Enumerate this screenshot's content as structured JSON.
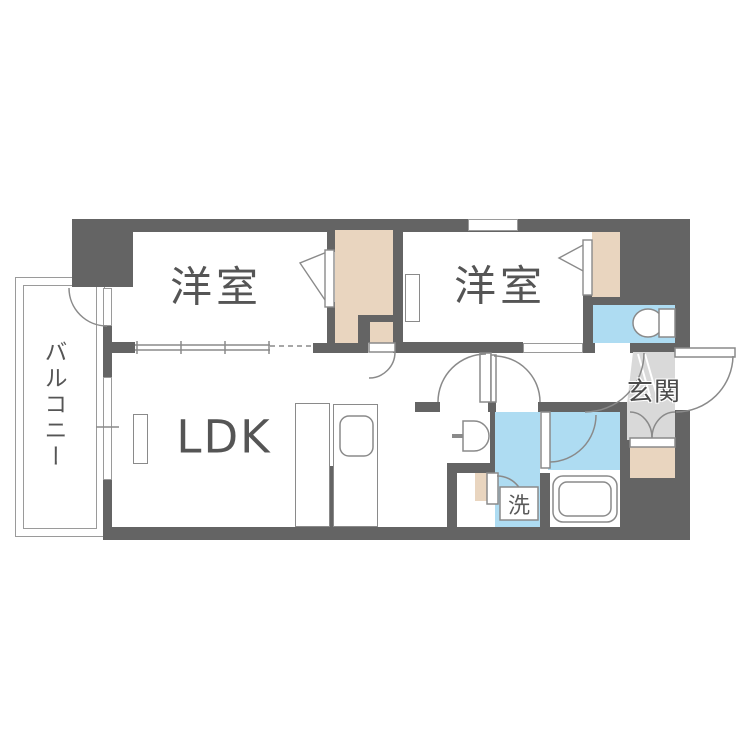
{
  "plan": {
    "type": "apartment-floor-plan",
    "labels": {
      "room_left": "洋室",
      "room_right": "洋室",
      "ldk": "LDK",
      "balcony": "バルコニー",
      "entrance": "玄関",
      "laundry": "洗"
    },
    "colors": {
      "wall": "#646464",
      "closet": "#e9d5bf",
      "wet": "#aedcf2",
      "entrance_floor": "#d9d9d9",
      "line": "#8a8a8a",
      "text": "#555555",
      "bg": "#ffffff"
    }
  }
}
